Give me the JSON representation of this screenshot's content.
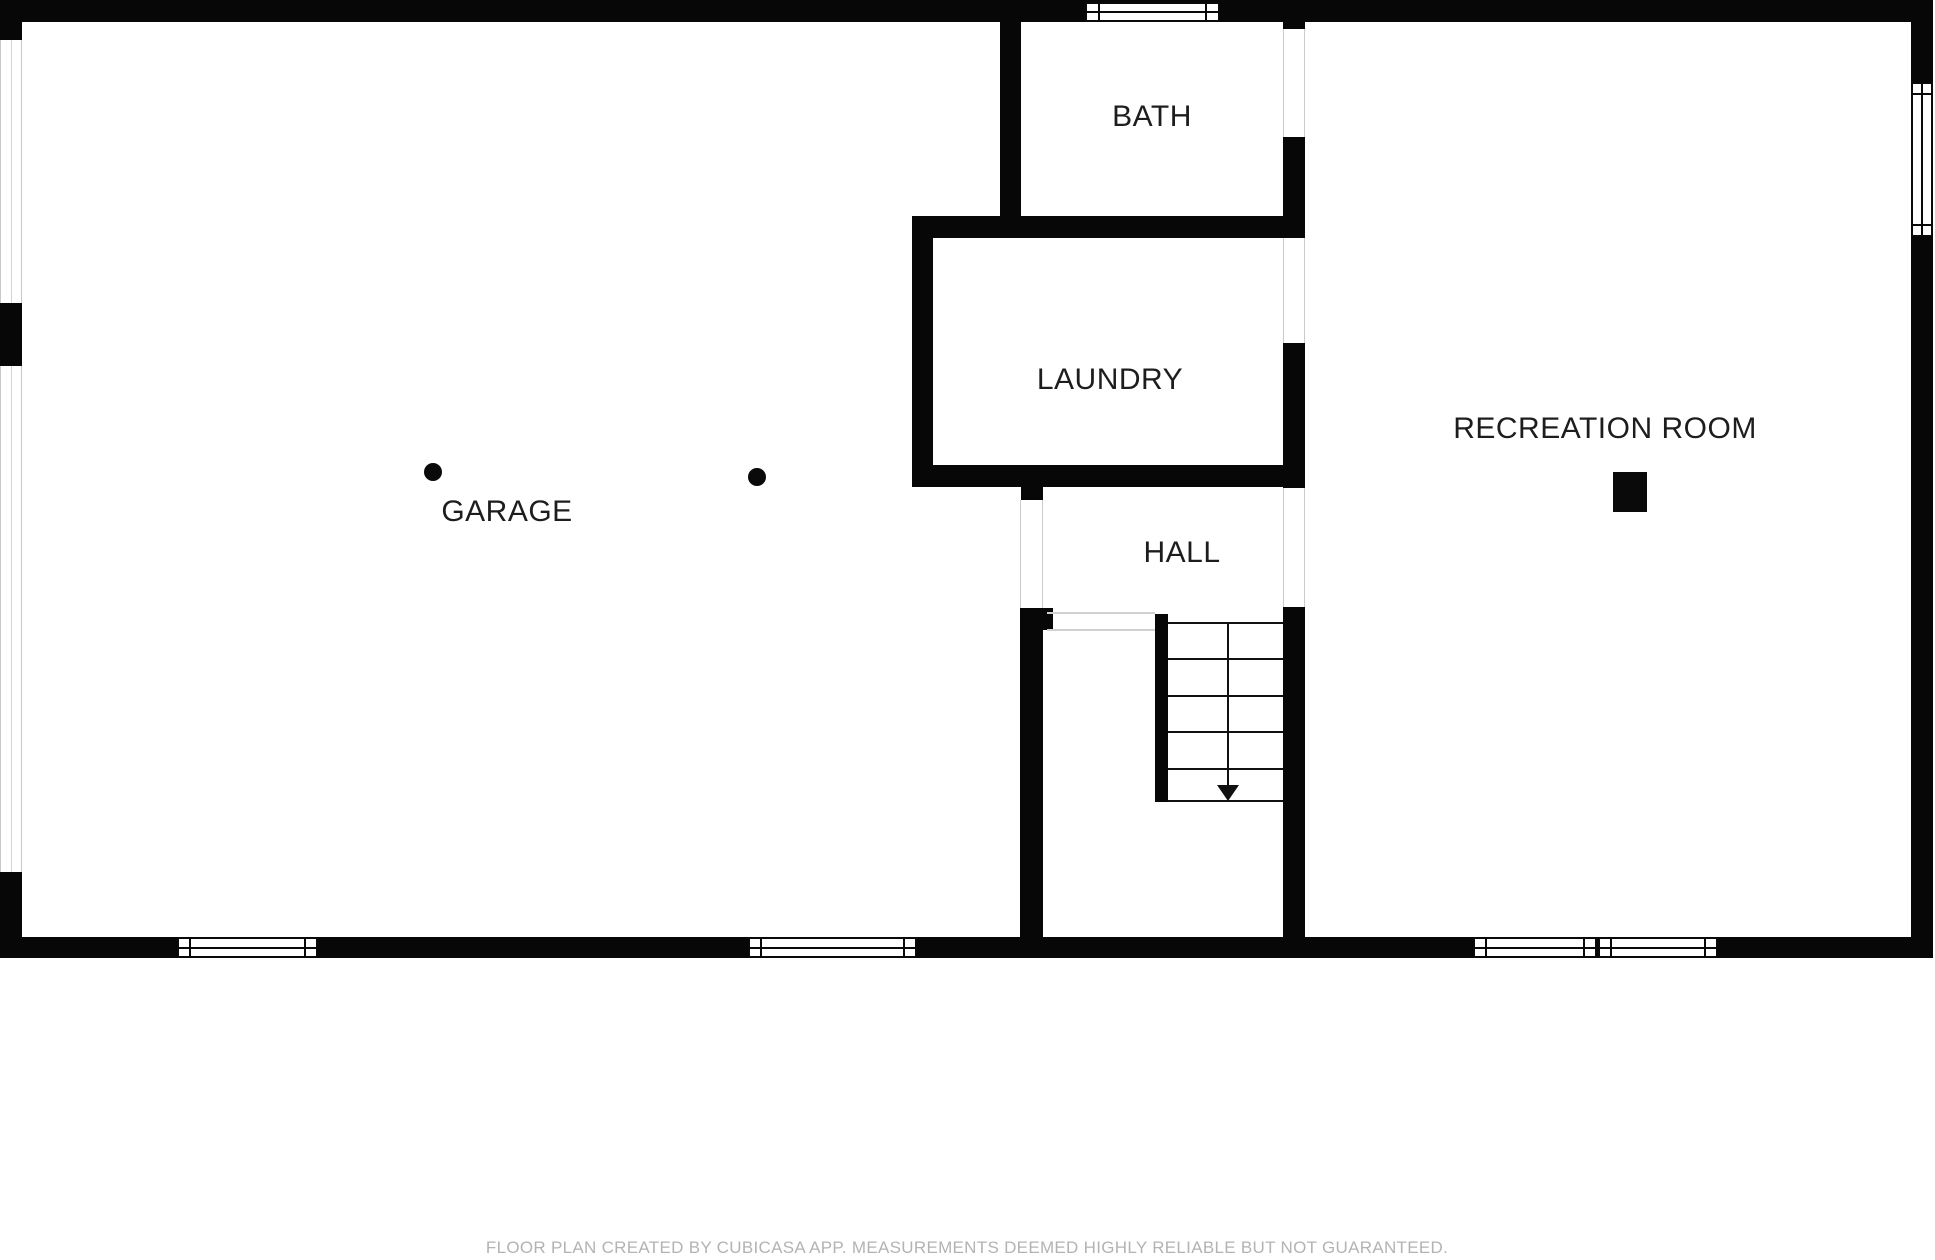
{
  "rooms": {
    "garage": {
      "label": "GARAGE"
    },
    "bath": {
      "label": "BATH"
    },
    "laundry": {
      "label": "LAUNDRY"
    },
    "hall": {
      "label": "HALL"
    },
    "recreation": {
      "label": "RECREATION ROOM"
    }
  },
  "footer": {
    "disclaimer": "FLOOR PLAN CREATED BY CUBICASA APP. MEASUREMENTS DEEMED HIGHLY RELIABLE BUT NOT GUARANTEED."
  },
  "colors": {
    "wall": "#070707",
    "label_text": "#1d1d1d",
    "footer_text": "#b3b3b3",
    "background": "#ffffff",
    "opening_hairline": "#cccccc"
  },
  "symbols": {
    "stair_direction": "down-arrow",
    "garage_columns": 2,
    "recreation_column": 1
  }
}
